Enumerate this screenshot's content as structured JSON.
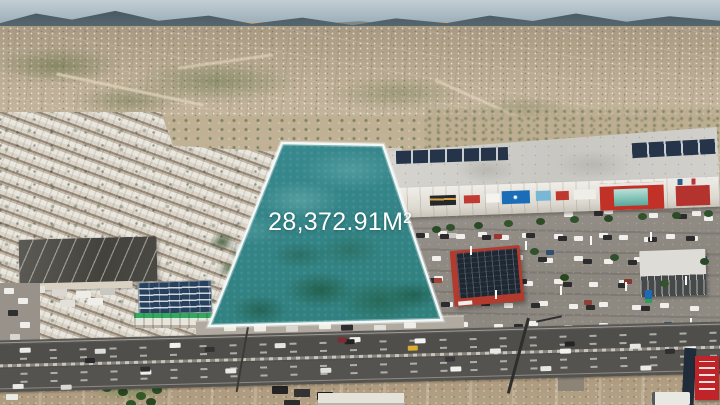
{
  "overlay": {
    "area_label": "28,372.91M²",
    "parcel_fill_color": "#35868A",
    "parcel_outline_color": "#F2F8F7",
    "label_text_color": "#FFFFFF"
  }
}
